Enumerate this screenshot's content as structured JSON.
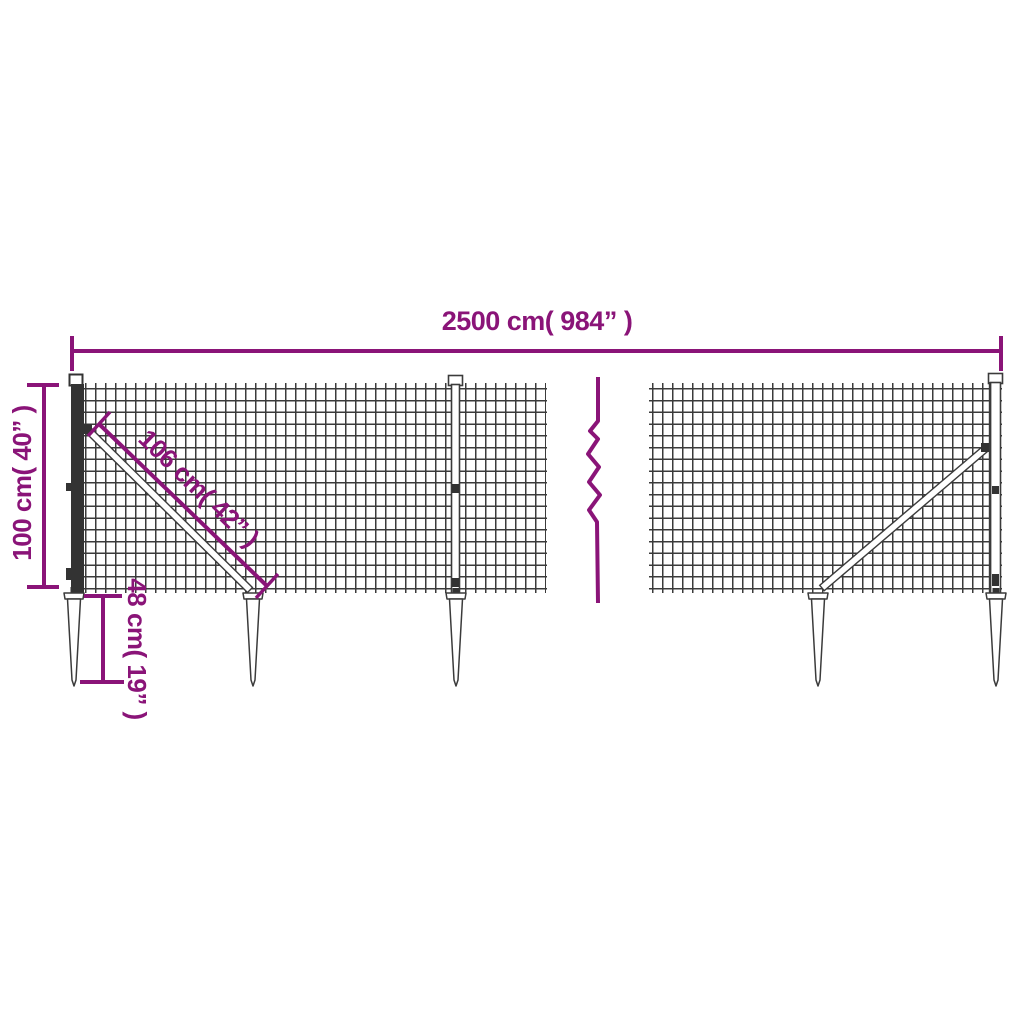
{
  "dimensions": {
    "total_length": "2500 cm( 984” )",
    "fence_height": "100 cm( 40” )",
    "brace_length": "106 cm( 42” )",
    "spike_depth": "48 cm( 19” )"
  },
  "colors": {
    "dimension_accent": "#8A1478",
    "wire": "#3B3B3B"
  }
}
